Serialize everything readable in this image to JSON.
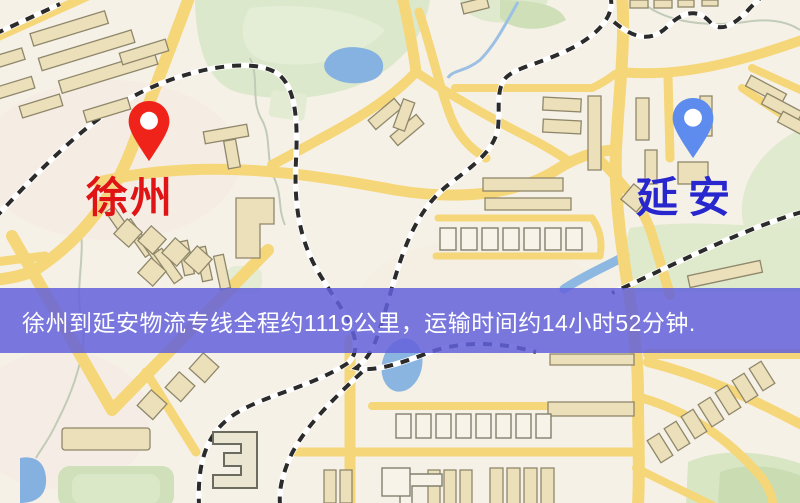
{
  "banner": {
    "text": "徐州到延安物流专线全程约1119公里，运输时间约14小时52分钟.",
    "distance_text": "约1119公里",
    "duration_text": "约14小时52分钟",
    "background_color": "rgba(99,97,219,0.85)",
    "text_color": "#ffffff"
  },
  "pins": {
    "origin": {
      "label": "徐州",
      "label_color": "#e01414",
      "pin_color": "#f0231b"
    },
    "destination": {
      "label": "延安",
      "label_color": "#2727cd",
      "pin_color": "#5d8cee"
    }
  },
  "map_palette": {
    "background": "#f6f1e7",
    "road": "#f5d678",
    "park": "#dce8cb",
    "water": "#85b2e0",
    "building": "#ece0ba",
    "building_outline": "#8f876b",
    "railway": "#2b2b2b"
  }
}
